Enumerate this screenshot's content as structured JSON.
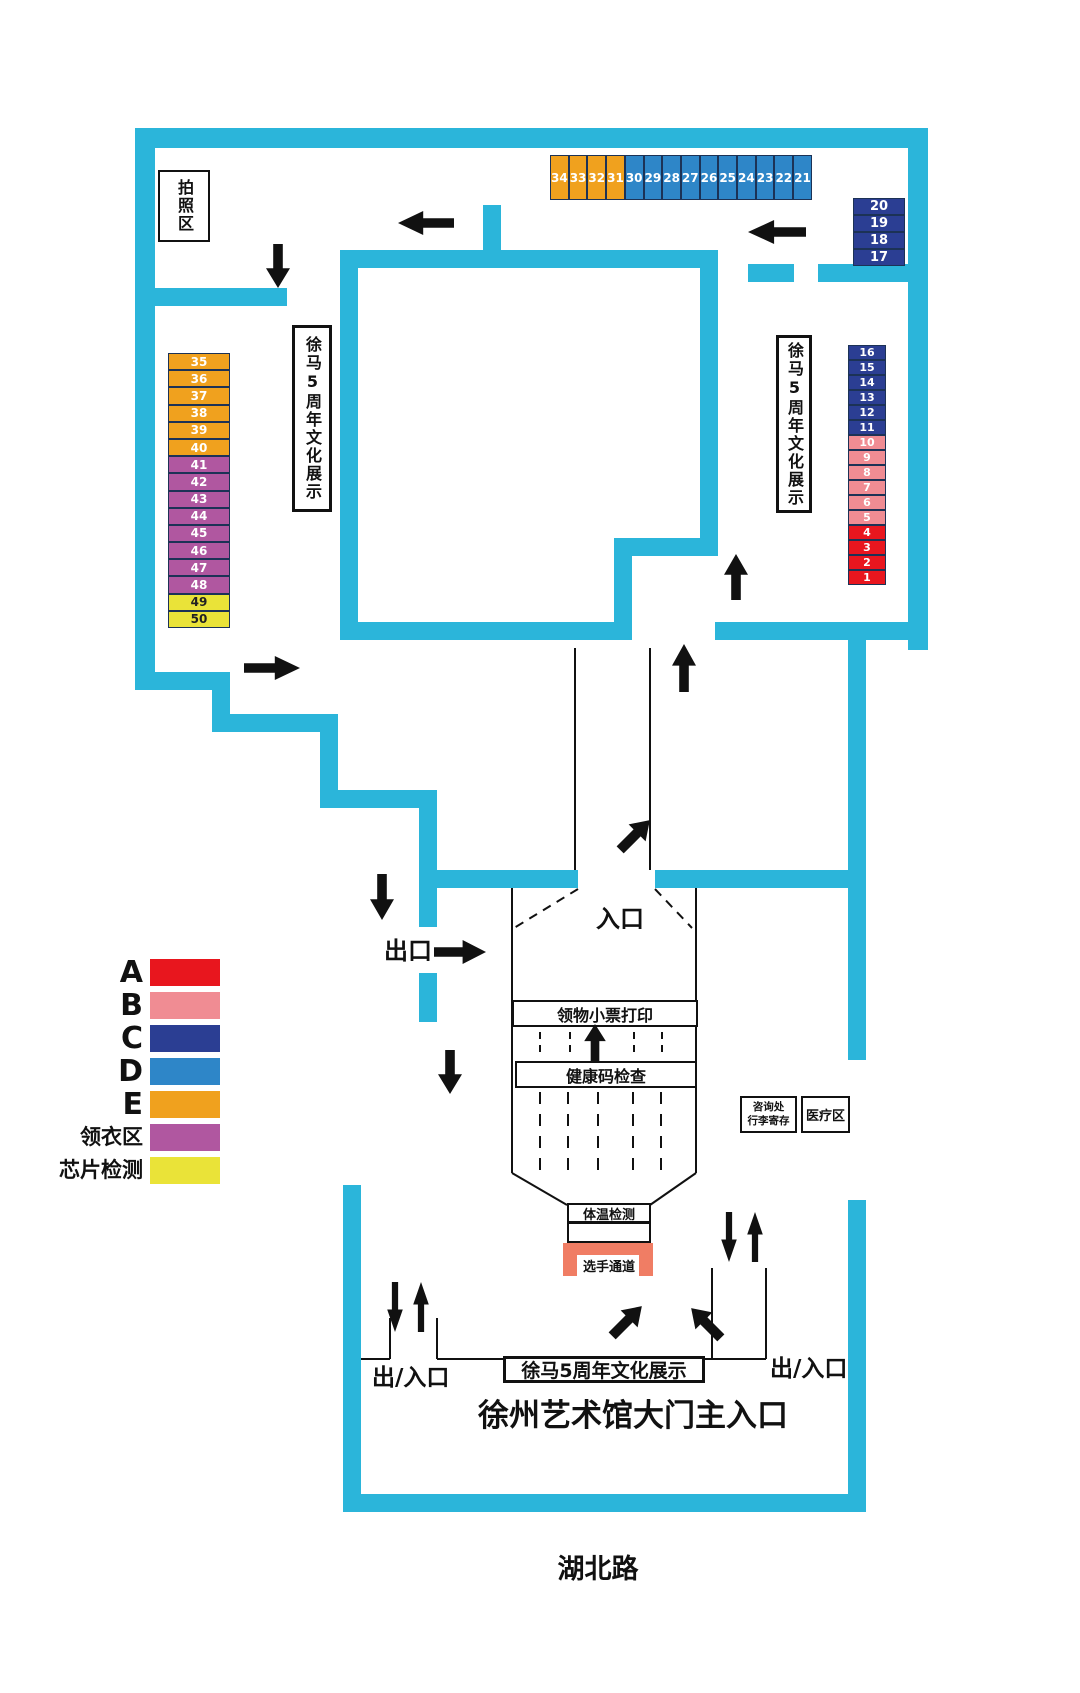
{
  "colors": {
    "wall": "#2BB5DA",
    "A": "#E8161E",
    "B": "#F08C93",
    "C": "#2B3E93",
    "D": "#2E86C8",
    "E": "#F0A11E",
    "collect": "#B057A0",
    "chip": "#EAE338",
    "channel": "#F07D64",
    "booth_border": "#1C3256"
  },
  "labels": {
    "photo_area": "拍照区",
    "exhibit_side": "徐马5周年文化展示",
    "entrance": "入口",
    "exit": "出口",
    "ticket_print": "领物小票打印",
    "health_check": "健康码检查",
    "info_line1": "咨询处",
    "info_line2": "行李寄存",
    "medical": "医疗区",
    "temp_check": "体温检测",
    "athlete_channel": "选手通道",
    "gate": "出/入口",
    "exhibit_bottom": "徐马5周年文化展示",
    "main_entrance": "徐州艺术馆大门主入口",
    "road": "湖北路"
  },
  "booths": {
    "top_row": [
      {
        "n": "34",
        "g": "E"
      },
      {
        "n": "33",
        "g": "E"
      },
      {
        "n": "32",
        "g": "E"
      },
      {
        "n": "31",
        "g": "E"
      },
      {
        "n": "30",
        "g": "D"
      },
      {
        "n": "29",
        "g": "D"
      },
      {
        "n": "28",
        "g": "D"
      },
      {
        "n": "27",
        "g": "D"
      },
      {
        "n": "26",
        "g": "D"
      },
      {
        "n": "25",
        "g": "D"
      },
      {
        "n": "24",
        "g": "D"
      },
      {
        "n": "23",
        "g": "D"
      },
      {
        "n": "22",
        "g": "D"
      },
      {
        "n": "21",
        "g": "D"
      }
    ],
    "right_upper": [
      {
        "n": "20",
        "g": "C"
      },
      {
        "n": "19",
        "g": "C"
      },
      {
        "n": "18",
        "g": "C"
      },
      {
        "n": "17",
        "g": "C"
      }
    ],
    "right_main": [
      {
        "n": "16",
        "g": "C"
      },
      {
        "n": "15",
        "g": "C"
      },
      {
        "n": "14",
        "g": "C"
      },
      {
        "n": "13",
        "g": "C"
      },
      {
        "n": "12",
        "g": "C"
      },
      {
        "n": "11",
        "g": "C"
      },
      {
        "n": "10",
        "g": "B"
      },
      {
        "n": "9",
        "g": "B"
      },
      {
        "n": "8",
        "g": "B"
      },
      {
        "n": "7",
        "g": "B"
      },
      {
        "n": "6",
        "g": "B"
      },
      {
        "n": "5",
        "g": "B"
      },
      {
        "n": "4",
        "g": "A"
      },
      {
        "n": "3",
        "g": "A"
      },
      {
        "n": "2",
        "g": "A"
      },
      {
        "n": "1",
        "g": "A"
      }
    ],
    "left_col": [
      {
        "n": "35",
        "g": "E"
      },
      {
        "n": "36",
        "g": "E"
      },
      {
        "n": "37",
        "g": "E"
      },
      {
        "n": "38",
        "g": "E"
      },
      {
        "n": "39",
        "g": "E"
      },
      {
        "n": "40",
        "g": "E"
      },
      {
        "n": "41",
        "g": "collect"
      },
      {
        "n": "42",
        "g": "collect"
      },
      {
        "n": "43",
        "g": "collect"
      },
      {
        "n": "44",
        "g": "collect"
      },
      {
        "n": "45",
        "g": "collect"
      },
      {
        "n": "46",
        "g": "collect"
      },
      {
        "n": "47",
        "g": "collect"
      },
      {
        "n": "48",
        "g": "collect"
      },
      {
        "n": "49",
        "g": "chip",
        "fg": "dark"
      },
      {
        "n": "50",
        "g": "chip",
        "fg": "dark"
      }
    ]
  },
  "legend": {
    "items": [
      {
        "label": "A",
        "g": "A"
      },
      {
        "label": "B",
        "g": "B"
      },
      {
        "label": "C",
        "g": "C"
      },
      {
        "label": "D",
        "g": "D"
      },
      {
        "label": "E",
        "g": "E"
      },
      {
        "label": "领衣区",
        "g": "collect"
      },
      {
        "label": "芯片检测",
        "g": "chip"
      }
    ]
  }
}
